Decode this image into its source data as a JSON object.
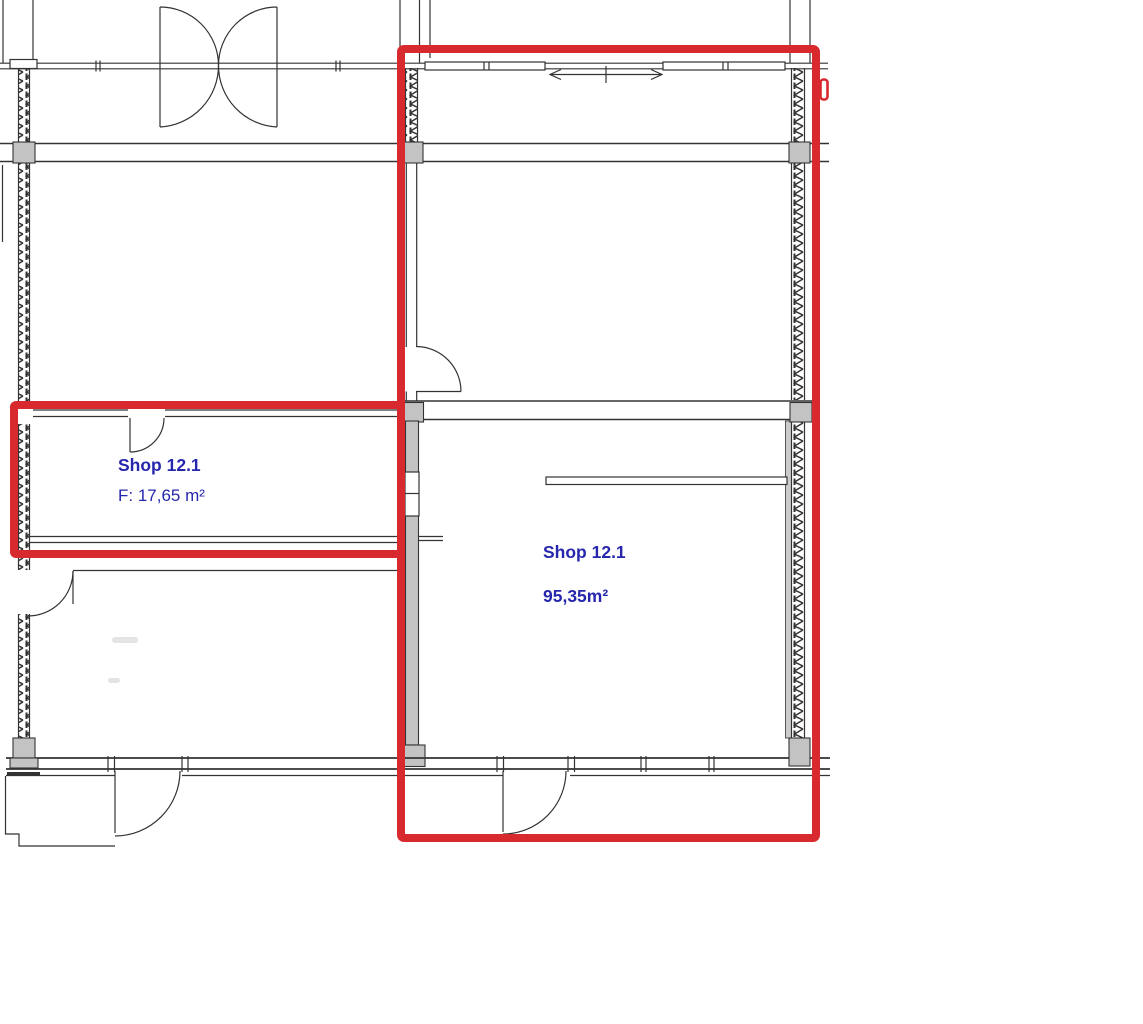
{
  "plan": {
    "type": "architectural-floor-plan",
    "rooms": [
      {
        "id": "shop-12-1-small",
        "name": "Shop 12.1",
        "area": "F: 17,65 m²"
      },
      {
        "id": "shop-12-1-large",
        "name": "Shop 12.1",
        "area": "95,35m²"
      }
    ],
    "colors": {
      "highlight": "#d8292f",
      "room_label": "#2727ae",
      "line": "#333333",
      "column_fill": "#c3c3c3",
      "wall_lining": "#cccccc"
    }
  }
}
